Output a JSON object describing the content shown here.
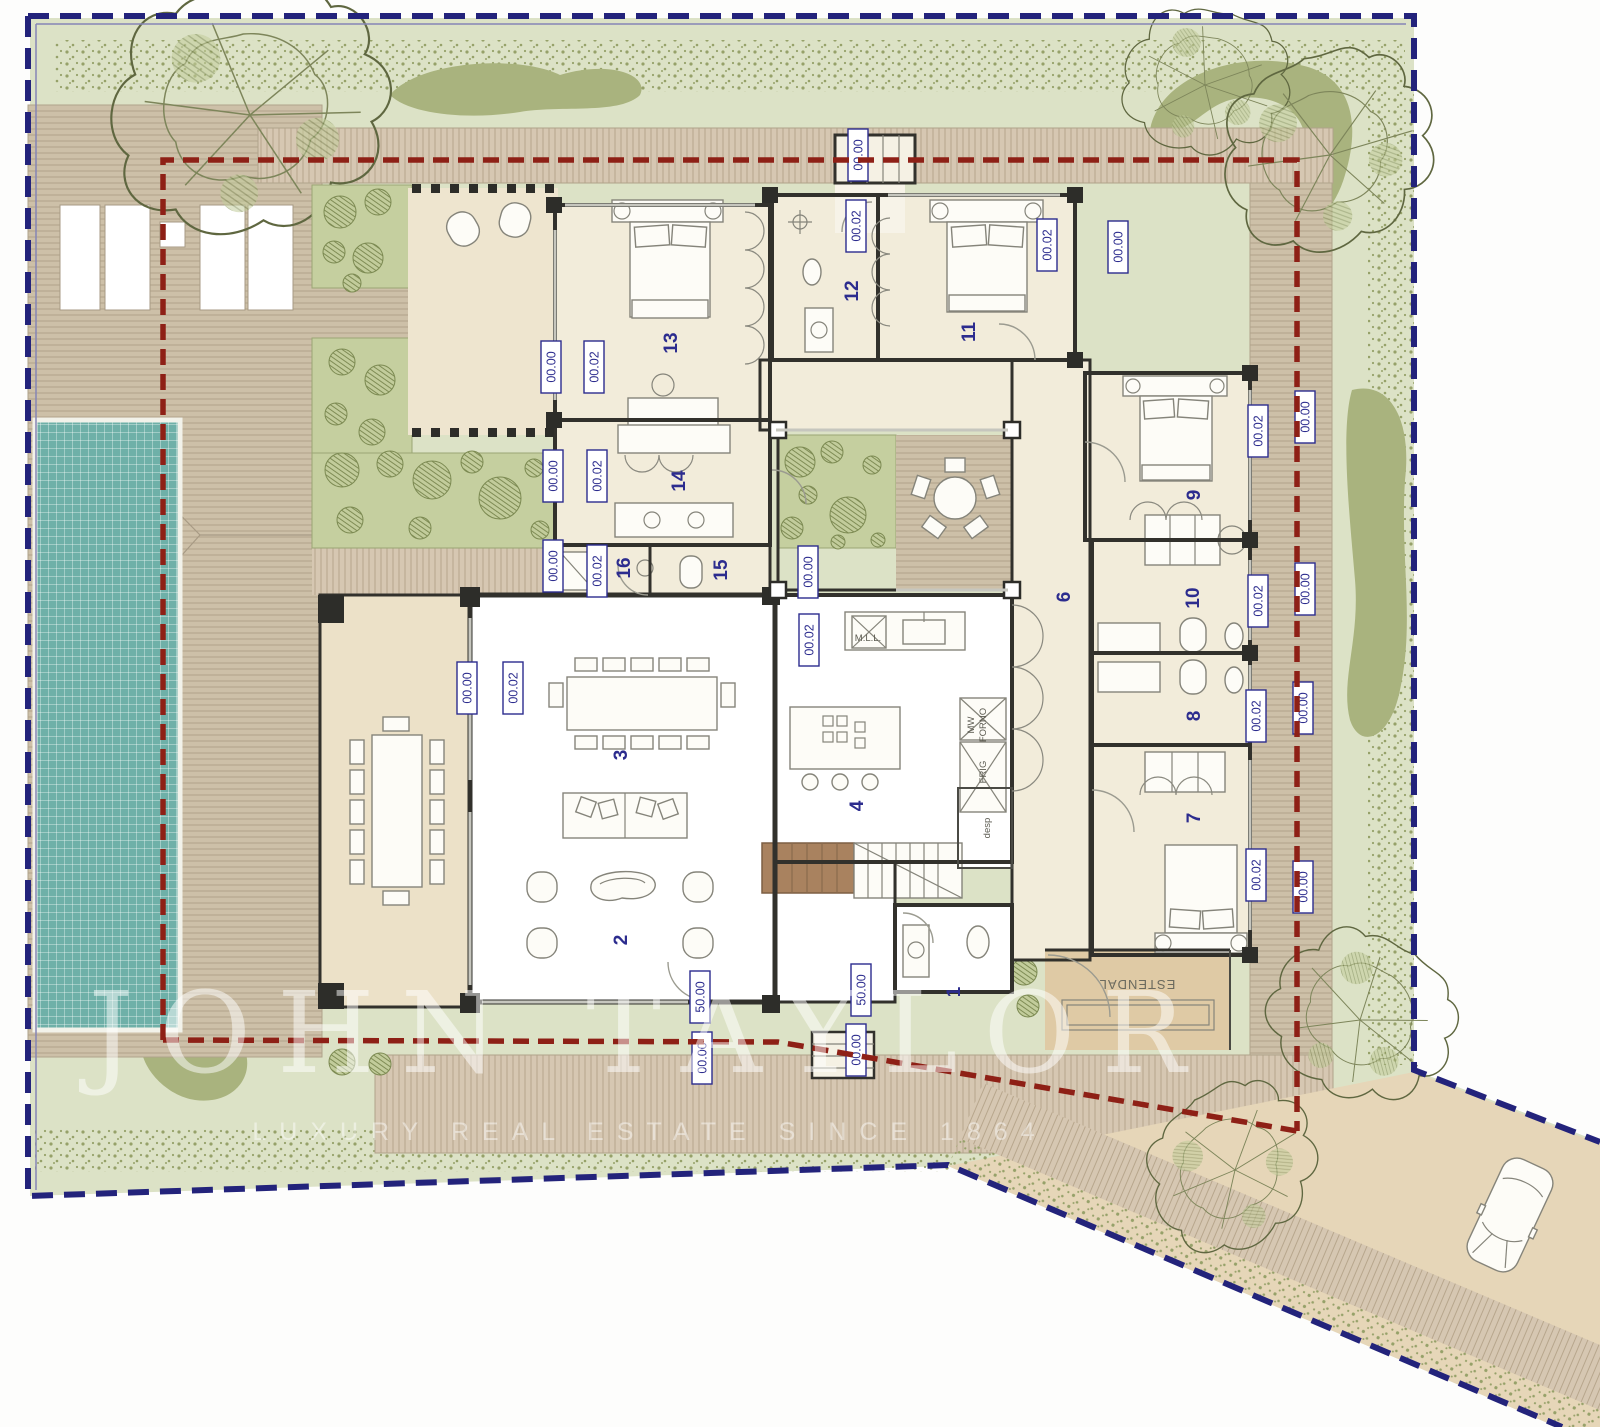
{
  "watermark": {
    "title": "JOHN TAYLOR",
    "subtitle": "LUXURY REAL ESTATE SINCE 1864"
  },
  "room_labels": {
    "r1": "1",
    "r2": "2",
    "r3": "3",
    "r4": "4",
    "r6": "6",
    "r7": "7",
    "r8": "8",
    "r9": "9",
    "r10": "10",
    "r11": "11",
    "r12": "12",
    "r13": "13",
    "r14": "14",
    "r15": "15",
    "r16": "16"
  },
  "elevation_values": {
    "zero": "00.00",
    "two": "00.02",
    "fifty": "50.00"
  },
  "annotations": {
    "estendal": "ESTENDAL",
    "mll": "M.L.L.",
    "mw": "MW",
    "forno": "FORNO",
    "frig": "FRIG",
    "desp": "desp"
  },
  "colors": {
    "boundary_blue": "#23237b",
    "setback_red": "#8e2016",
    "pool_teal": "#6fb0a8",
    "garden_green": "#dce2c6",
    "deck_brown": "#cfc2aa",
    "label_navy": "#2c2c8e"
  }
}
